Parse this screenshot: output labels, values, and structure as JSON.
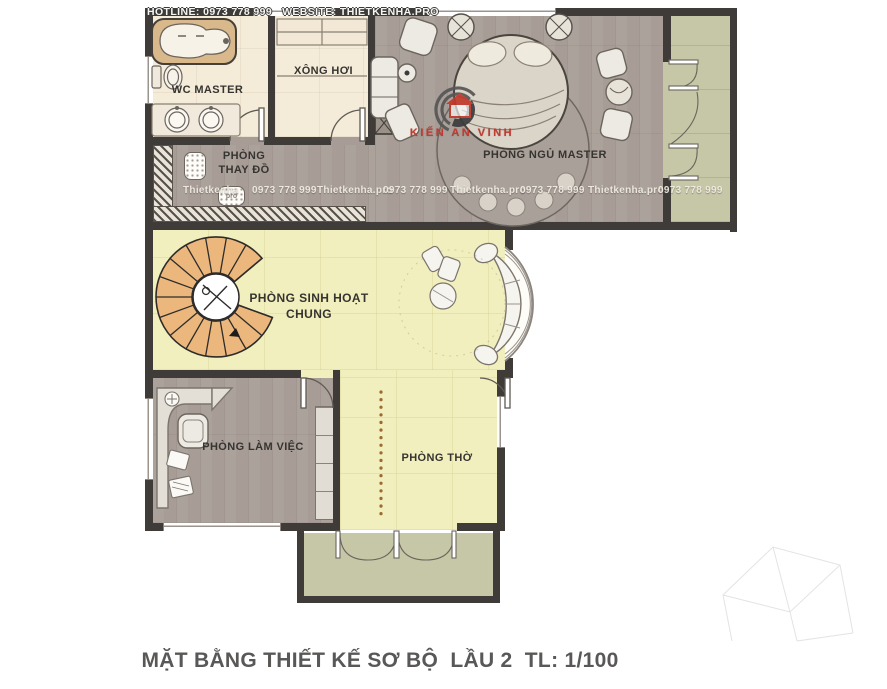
{
  "header": {
    "hotline": "HOTLINE: 0973 778 999   WEBSITE: THIETKENHA.PRO"
  },
  "rooms": {
    "wc_master": "WC MASTER",
    "sauna": "XÔNG HƠI",
    "master_bedroom": "PHÒNG  NGỦ MASTER",
    "closet": {
      "line1": "PHÒNG",
      "line2": "THAY ĐỒ"
    },
    "living": {
      "line1": "PHÒNG  SINH HOẠT",
      "line2": "CHUNG"
    },
    "office": "PHÒNG  LÀM VIỆC",
    "altar": "PHÒNG  THỜ"
  },
  "branding": {
    "logo_text": "KIẾN AN VINH",
    "watermark_badge": "pro",
    "watermarks": [
      "Thietkenha",
      "0973 778 999",
      "Thietkenha.pro",
      "0973 778 999",
      "Thietkenha.pro",
      "0973 778 999",
      "Thietkenha.pro",
      "0973 778 999"
    ]
  },
  "footer": {
    "title": "MẶT BẰNG THIẾT KẾ SƠ BỘ  LẦU 2  TL: 1/100"
  },
  "colors": {
    "wall": "#3e3b38",
    "wood_floor": "#a79c96",
    "cream_floor": "#f4ebd9",
    "yellow_floor": "#f2efbe",
    "balcony_floor": "#c6c7a6",
    "stair_tread": "#ecb77d",
    "accent_red": "#c23a30",
    "title_text": "#5a5857"
  }
}
